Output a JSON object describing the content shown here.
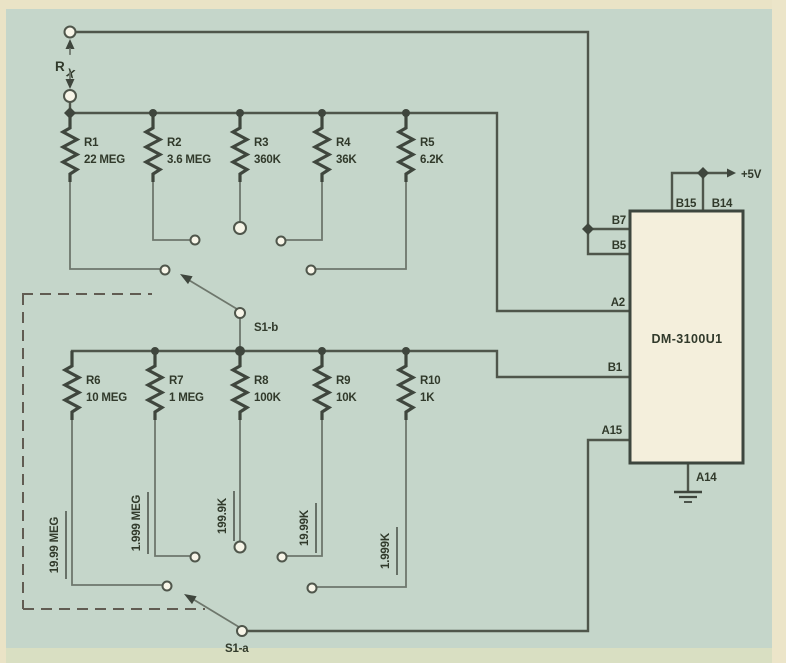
{
  "schematic": {
    "rx": {
      "base": "R",
      "sub": "X"
    },
    "top_resistors": [
      {
        "name": "R1",
        "value": "22 MEG"
      },
      {
        "name": "R2",
        "value": "3.6 MEG"
      },
      {
        "name": "R3",
        "value": "360K"
      },
      {
        "name": "R4",
        "value": "36K"
      },
      {
        "name": "R5",
        "value": "6.2K"
      }
    ],
    "bottom_resistors": [
      {
        "name": "R6",
        "value": "10 MEG"
      },
      {
        "name": "R7",
        "value": "1 MEG"
      },
      {
        "name": "R8",
        "value": "100K"
      },
      {
        "name": "R9",
        "value": "10K"
      },
      {
        "name": "R10",
        "value": "1K"
      }
    ],
    "ranges": [
      "19.99 MEG",
      "1.999 MEG",
      "199.9K",
      "19.99K",
      "1.999K"
    ],
    "switches": {
      "s1b": "S1-b",
      "s1a": "S1-a"
    },
    "ic": {
      "name": "DM-3100U1",
      "pins": {
        "b7": "B7",
        "b5": "B5",
        "a2": "A2",
        "b1": "B1",
        "a15": "A15",
        "b15": "B15",
        "b14": "B14",
        "a14": "A14"
      },
      "supply": "+5V"
    },
    "colors": {
      "canvas": "#c5d6ca",
      "page_border": "#eae3c6",
      "line": "#4f564b",
      "ic_fill": "#f4efdc"
    }
  }
}
